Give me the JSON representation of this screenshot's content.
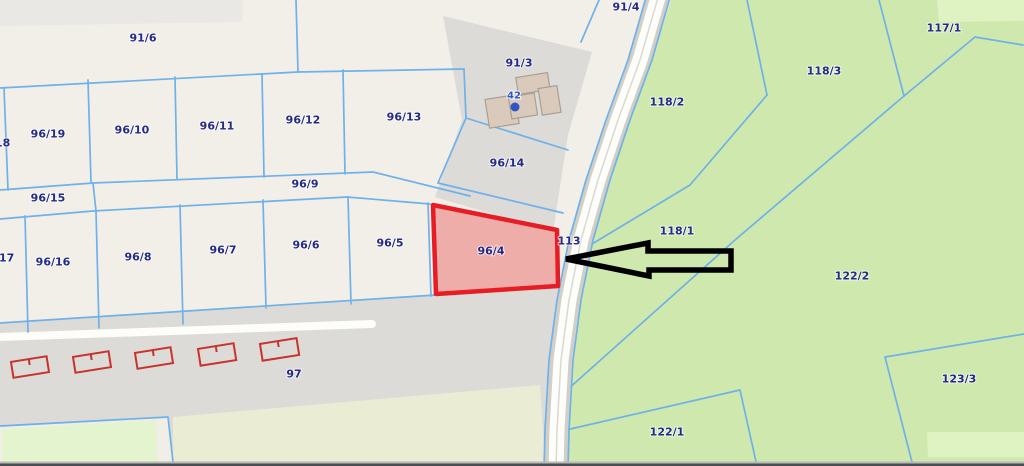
{
  "map": {
    "description": "cadastral-parcel-map",
    "highlight": {
      "parcel": "96/4",
      "outline_color": "#e71d25",
      "fill_color": "#f2b0ae"
    },
    "arrow_annotation": {
      "color": "#000000",
      "points_to": "96/4",
      "direction": "left"
    },
    "house_marker": {
      "number": "42",
      "color": "#3155c6"
    },
    "colors": {
      "background": "#f2efe8",
      "residential_gray": "#dcdbd8",
      "road_gray_band": "#e9e8e5",
      "road_fill": "#fdfdfa",
      "road_casing": "#d2cfc7",
      "greenery": "#cfe8ad",
      "greenery_light": "#def2c2",
      "pale_field": "#ebecd4",
      "bright_field": "#e4f4cf",
      "parcel_line": "#6fb1e9",
      "label_navy": "#232a87",
      "building_fill": "#d9cabc",
      "building_stroke": "#a9a092",
      "red_building_stroke": "#c8332b",
      "bottom_band": "#4b4d55"
    },
    "labels": [
      {
        "text": "91/6",
        "x": 143,
        "y": 38,
        "kind": "parcel"
      },
      {
        "text": "96/19",
        "x": 48,
        "y": 134,
        "kind": "parcel"
      },
      {
        "text": "96/10",
        "x": 132,
        "y": 130,
        "kind": "parcel"
      },
      {
        "text": "96/11",
        "x": 217,
        "y": 126,
        "kind": "parcel"
      },
      {
        "text": "96/12",
        "x": 303,
        "y": 120,
        "kind": "parcel"
      },
      {
        "text": "96/13",
        "x": 404,
        "y": 117,
        "kind": "parcel"
      },
      {
        "text": "96/18",
        "x": -7,
        "y": 143,
        "kind": "parcel"
      },
      {
        "text": "96/15",
        "x": 48,
        "y": 198,
        "kind": "parcel"
      },
      {
        "text": "96/9",
        "x": 305,
        "y": 184,
        "kind": "parcel"
      },
      {
        "text": "96/17",
        "x": -3,
        "y": 258,
        "kind": "parcel"
      },
      {
        "text": "96/16",
        "x": 53,
        "y": 262,
        "kind": "parcel"
      },
      {
        "text": "96/8",
        "x": 138,
        "y": 257,
        "kind": "parcel"
      },
      {
        "text": "96/7",
        "x": 223,
        "y": 250,
        "kind": "parcel"
      },
      {
        "text": "96/6",
        "x": 306,
        "y": 245,
        "kind": "parcel"
      },
      {
        "text": "96/5",
        "x": 390,
        "y": 243,
        "kind": "parcel"
      },
      {
        "text": "96/4",
        "x": 491,
        "y": 251,
        "kind": "parcel"
      },
      {
        "text": "96/14",
        "x": 507,
        "y": 163,
        "kind": "parcel"
      },
      {
        "text": "91/3",
        "x": 519,
        "y": 63,
        "kind": "parcel"
      },
      {
        "text": "91/4",
        "x": 626,
        "y": 7,
        "kind": "parcel"
      },
      {
        "text": "113",
        "x": 569,
        "y": 241,
        "kind": "parcel"
      },
      {
        "text": "117/1",
        "x": 944,
        "y": 28,
        "kind": "parcel"
      },
      {
        "text": "118/3",
        "x": 824,
        "y": 71,
        "kind": "parcel"
      },
      {
        "text": "118/2",
        "x": 667,
        "y": 102,
        "kind": "parcel"
      },
      {
        "text": "118/1",
        "x": 677,
        "y": 231,
        "kind": "parcel"
      },
      {
        "text": "122/2",
        "x": 852,
        "y": 276,
        "kind": "parcel"
      },
      {
        "text": "122/1",
        "x": 667,
        "y": 432,
        "kind": "parcel"
      },
      {
        "text": "123/3",
        "x": 959,
        "y": 379,
        "kind": "parcel"
      },
      {
        "text": "97",
        "x": 294,
        "y": 374,
        "kind": "parcel"
      }
    ]
  }
}
